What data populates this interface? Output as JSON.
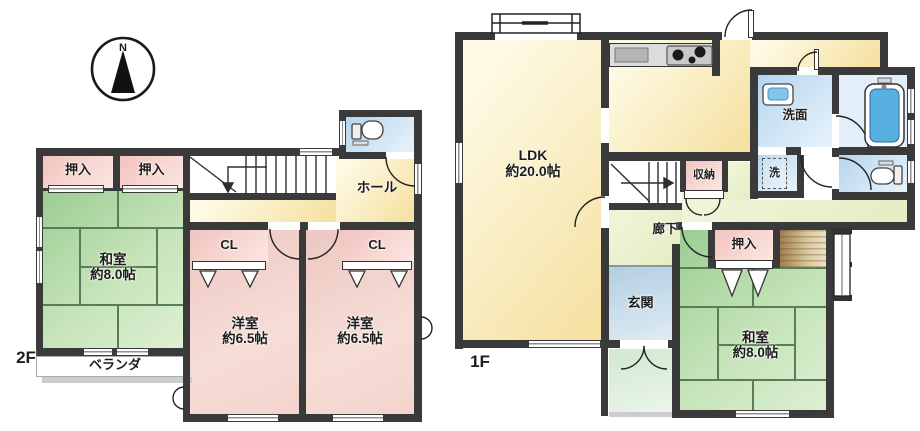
{
  "compass": {
    "label": "N"
  },
  "floors": {
    "f2": {
      "label": "2F",
      "rooms": {
        "oshiire1": "押入",
        "oshiire2": "押入",
        "washitsu": {
          "name": "和室",
          "size": "約8.0帖"
        },
        "veranda": "ベランダ",
        "hall": "ホール",
        "cl1": "CL",
        "cl2": "CL",
        "youshitsu1": {
          "name": "洋室",
          "size": "約6.5帖"
        },
        "youshitsu2": {
          "name": "洋室",
          "size": "約6.5帖"
        }
      }
    },
    "f1": {
      "label": "1F",
      "rooms": {
        "ldk": {
          "name": "LDK",
          "size": "約20.0帖"
        },
        "senmen": "洗面",
        "laundry": "洗",
        "shuunou": "収納",
        "rouka": "廊下",
        "genkan": "玄関",
        "oshiire": "押入",
        "washitsu": {
          "name": "和室",
          "size": "約8.0帖"
        }
      }
    }
  },
  "icons": {
    "toilet_2f": "toilet-icon",
    "toilet_1f": "toilet-icon",
    "bathtub": "bathtub-icon",
    "sink": "washbasin-icon",
    "stove": "kitchen-stove-icon",
    "compass": "compass-north-icon"
  },
  "colors": {
    "wall": "#3a3a3a",
    "tatami_green": "#9bcd92",
    "tatami_line": "#587e58",
    "closet_pink": "#f2c3bf",
    "western_room_pink": "#edc7c1",
    "ldk_cream": "#f5e1a2",
    "corridor_green": "#e4edc3",
    "water_blue": "#b5d5ee",
    "entrance_blue": "#b3cee1",
    "tub_blue": "#58b0e0",
    "engawa_wood": "#a17e4e"
  }
}
